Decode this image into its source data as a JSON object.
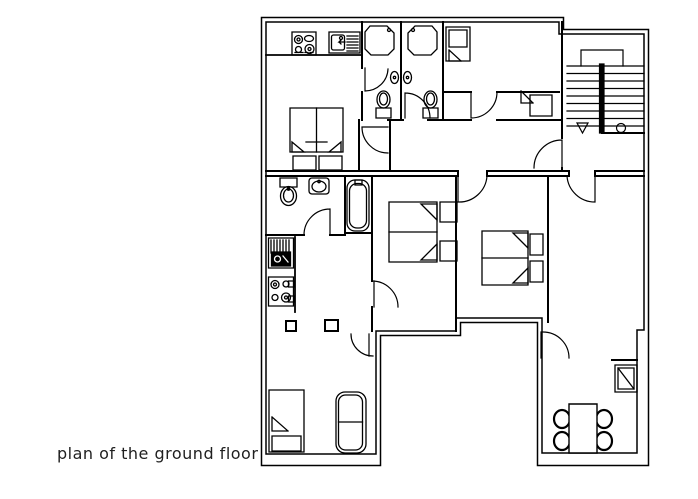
{
  "caption": {
    "text": "plan of the ground floor"
  },
  "drawing": {
    "background_color": "#ffffff",
    "line_color": "#000000",
    "caption_color": "#1f1f1f",
    "type": "architectural-floor-plan",
    "fixtures": [
      "stove-top",
      "kitchen-sink-drainer",
      "shower-tray",
      "wall-basin",
      "toilet",
      "bathtub",
      "washbasin",
      "double-bed",
      "pillow",
      "nightstand",
      "single-bed",
      "sofa",
      "closet",
      "shelf-unit",
      "dining-table",
      "chair",
      "sideboard",
      "staircase",
      "stair-down-arrow",
      "stair-start-marker",
      "door-swing",
      "column"
    ]
  }
}
